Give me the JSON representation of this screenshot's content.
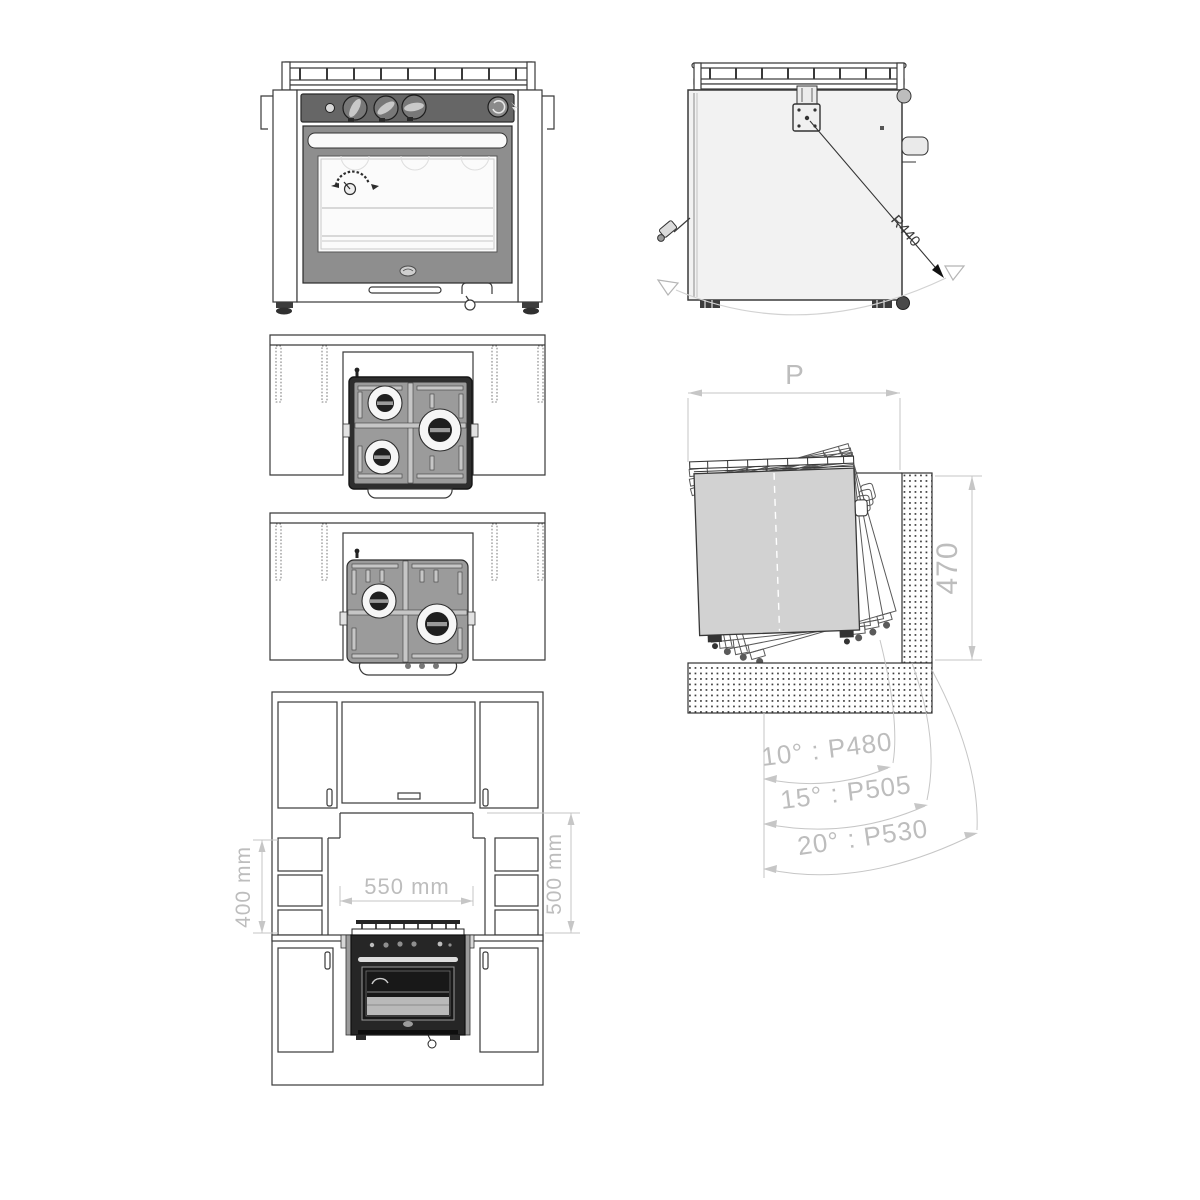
{
  "drawing": {
    "dimensions": {
      "cabinet_left_height": "400 mm",
      "cabinet_opening_width": "550 mm",
      "cabinet_right_height": "500 mm",
      "swing_clearance_width": "P",
      "swing_recess_depth": "470",
      "swivel_radius": "R440",
      "tilt_table": [
        {
          "label": "10° : P480"
        },
        {
          "label": "15° : P505"
        },
        {
          "label": "20° : P530"
        }
      ]
    },
    "colors": {
      "line": "#3a3a3a",
      "dimension": "#c0c0c0",
      "control_panel": "#666666",
      "oven_door": "#8e8e8e",
      "hob_surface": "#9b9b9b",
      "swing_body_fill": "#d2d2d2"
    }
  }
}
